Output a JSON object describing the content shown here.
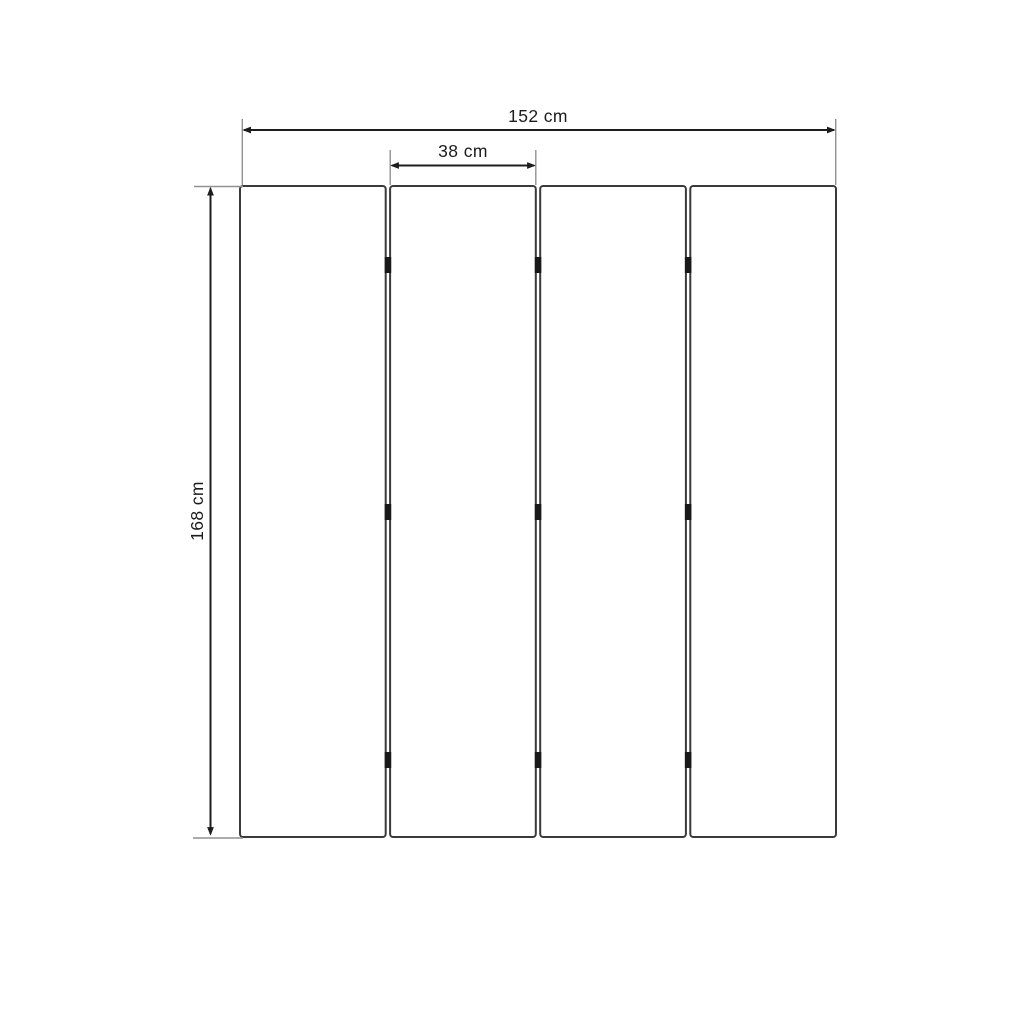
{
  "diagram": {
    "panel_count": 4,
    "joint_count": 3,
    "hinges_per_joint": 3,
    "colors": {
      "background": "#ffffff",
      "dimension_line": "#1d1d1d",
      "extension_line": "#919191",
      "panel_border": "#3a3a3a",
      "hinge": "#191919",
      "label_text": "#1c1c1c"
    },
    "dimensions": {
      "total_width": {
        "value": 152,
        "unit": "cm",
        "label": "152 cm"
      },
      "panel_width": {
        "value": 38,
        "unit": "cm",
        "label": "38 cm"
      },
      "height": {
        "value": 168,
        "unit": "cm",
        "label": "168 cm"
      }
    }
  }
}
